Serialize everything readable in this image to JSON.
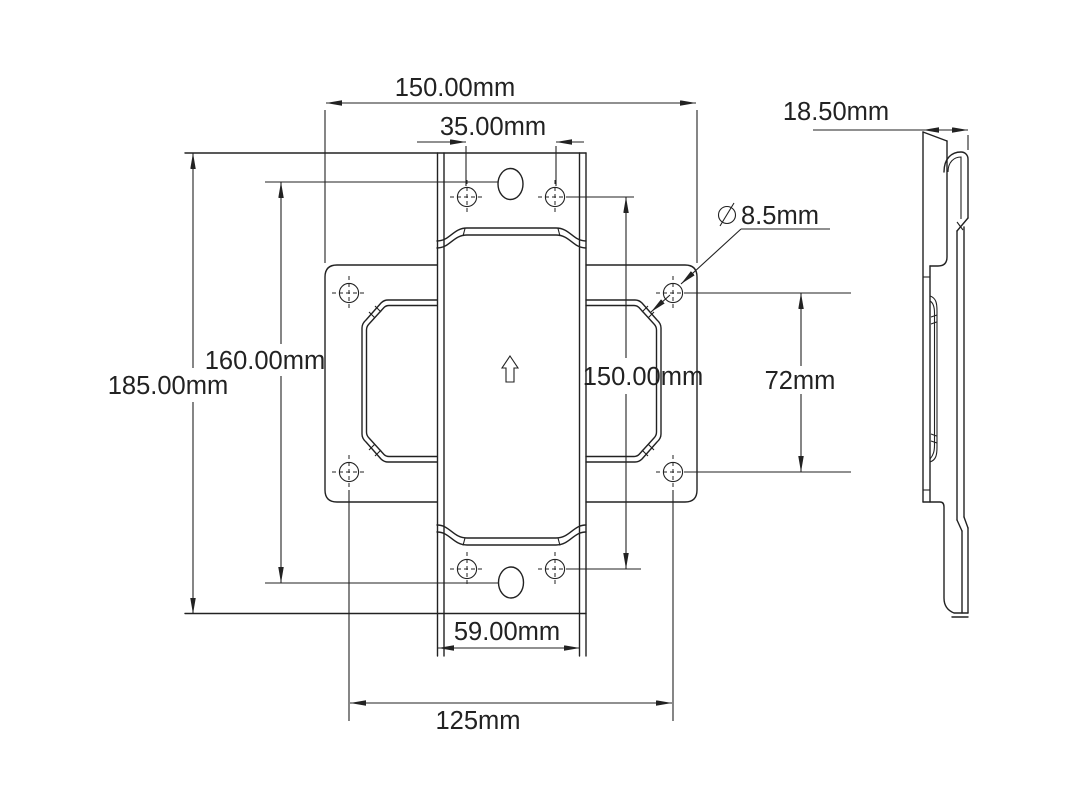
{
  "colors": {
    "background": "#ffffff",
    "line": "#222222"
  },
  "drawing": {
    "type": "engineering-dimension-drawing",
    "views": {
      "front": "front-view",
      "side": "side-profile-view"
    },
    "dimensions": {
      "overall_width": "150.00mm",
      "top_hole_spacing": "35.00mm",
      "side_thickness": "18.50mm",
      "diameter_symbol": "⌀",
      "hole_diameter": "8.5mm",
      "total_height": "185.00mm",
      "slot_spacing": "160.00mm",
      "tab_hole_span": "150.00mm",
      "plate_hole_row_spacing": "72mm",
      "tab_width": "59.00mm",
      "plate_hole_column_spacing": "125mm"
    }
  }
}
